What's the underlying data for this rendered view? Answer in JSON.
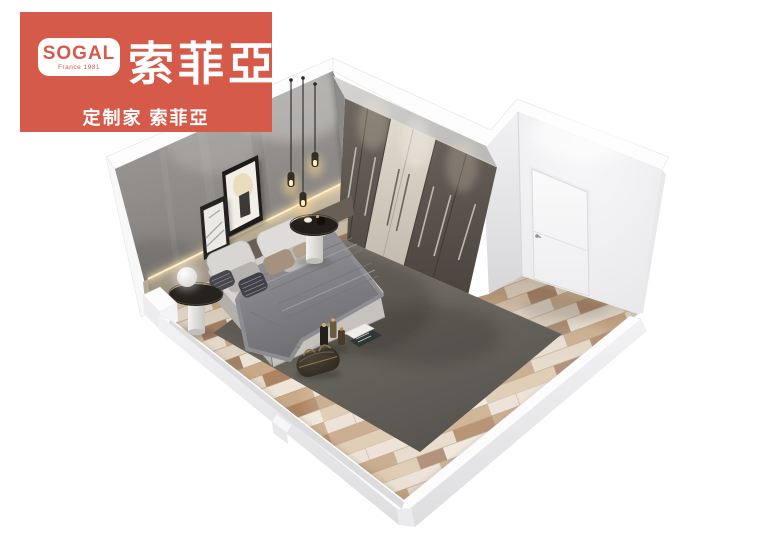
{
  "logo": {
    "brand": "SOGAL",
    "origin": "France 1981",
    "brand_cn": "索菲亞",
    "tagline": "定制家 索菲亞",
    "background_color": "#d65a49",
    "text_color": "#ffffff"
  },
  "scene": {
    "type": "isometric-bedroom-render",
    "background_color": "#ffffff",
    "palette": {
      "concrete_wall": "#8a8785",
      "wood_headboard_panel": "#b3a793",
      "led_glow": "#ffeec6",
      "wardrobe_dark_doors": "#57504a",
      "wardrobe_center_doors": "#d6cfc3",
      "wardrobe_top": "#c8c6c4",
      "entry_walls": "#f1f1f3",
      "entry_door": "#f8f8f9",
      "floor_wood_light": "#e8dccb",
      "floor_wood_mid": "#c9ab8a",
      "floor_wood_dark": "#9a6f4e",
      "rug": "#6e6a62",
      "bed_duvet": "#d2cfcc",
      "bed_blanket": "#8e8d91",
      "pillow_accent": "#a5927e",
      "nightstand": "#26231f",
      "baseboard": "#ececee"
    },
    "elements": [
      "concrete-accent-wall",
      "wood-headboard-panel",
      "led-strip",
      "picture-frame-small",
      "picture-frame-large",
      "pendant-lights",
      "six-door-wardrobe",
      "entry-nook",
      "entry-door",
      "wood-plank-floor",
      "area-rug",
      "double-bed",
      "pillows",
      "throw-blanket",
      "nightstand-left",
      "sphere-lamp",
      "nightstand-right",
      "decor-bottles",
      "magazines",
      "duffel-bag",
      "baseboard-plinths"
    ]
  }
}
